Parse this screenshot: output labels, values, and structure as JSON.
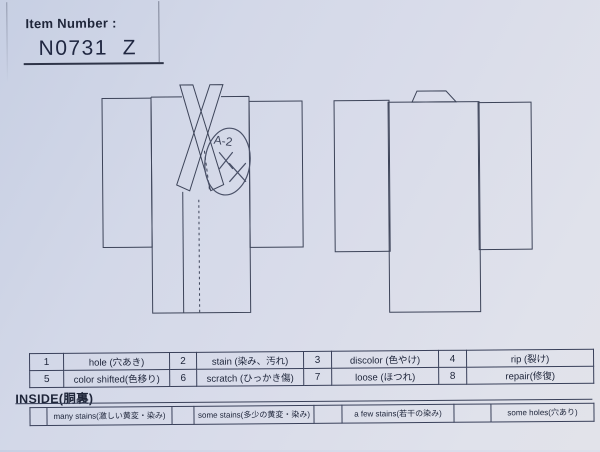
{
  "page": {
    "paper_color_top": "#c7cfe3",
    "paper_color_bottom": "#e2e3ea",
    "line_color": "#39405a",
    "text_color": "#20273c"
  },
  "header": {
    "label": "Item Number :",
    "item_number": "N0731  Z"
  },
  "annotation": {
    "code": "A-2"
  },
  "condition_table": {
    "row1": [
      {
        "num": "1",
        "label": "hole (穴あき)"
      },
      {
        "num": "2",
        "label": "stain (染み、汚れ)"
      },
      {
        "num": "3",
        "label": "discolor (色やけ)"
      },
      {
        "num": "4",
        "label": "rip (裂け)"
      }
    ],
    "row2": [
      {
        "num": "5",
        "label": "color shifted(色移り)"
      },
      {
        "num": "6",
        "label": "scratch (ひっかき傷)"
      },
      {
        "num": "7",
        "label": "loose (ほつれ)"
      },
      {
        "num": "8",
        "label": "repair(修復)"
      }
    ]
  },
  "inside": {
    "title": "INSIDE(胴裏)",
    "options": [
      {
        "label": "many stains(激しい黄変・染み)"
      },
      {
        "label": "some stains(多少の黄変・染み)"
      },
      {
        "label": "a few stains(若干の染み)"
      },
      {
        "label": "some holes(穴あり)"
      }
    ]
  }
}
